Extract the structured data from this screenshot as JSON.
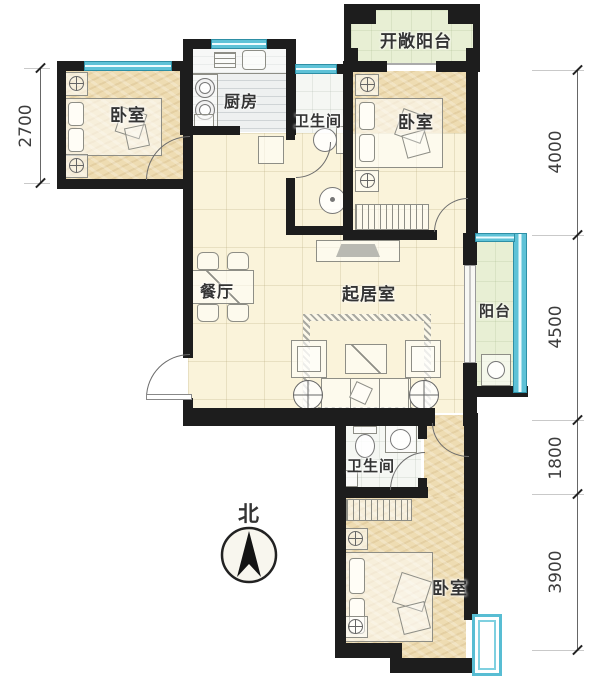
{
  "rooms": {
    "bedroom_top_left": "卧室",
    "kitchen": "厨房",
    "bathroom_top": "卫生间",
    "bedroom_top_right": "卧室",
    "open_balcony": "开敞阳台",
    "dining_room": "餐厅",
    "living_room": "起居室",
    "balcony": "阳台",
    "bathroom_bottom": "卫生间",
    "bedroom_bottom": "卧室"
  },
  "compass": {
    "north": "北"
  },
  "dimensions": {
    "left": [
      {
        "value": "2700"
      }
    ],
    "right": [
      {
        "value": "4000"
      },
      {
        "value": "4500"
      },
      {
        "value": "1800"
      },
      {
        "value": "3900"
      }
    ]
  },
  "colors": {
    "wall": "#1d1d1d",
    "window": "#5fc3d8",
    "bedroom_floor": "#eedcb2",
    "tile_floor": "#faf3da",
    "balcony_floor": "#e8efd4",
    "kitchen_floor": "#eef0f0"
  }
}
